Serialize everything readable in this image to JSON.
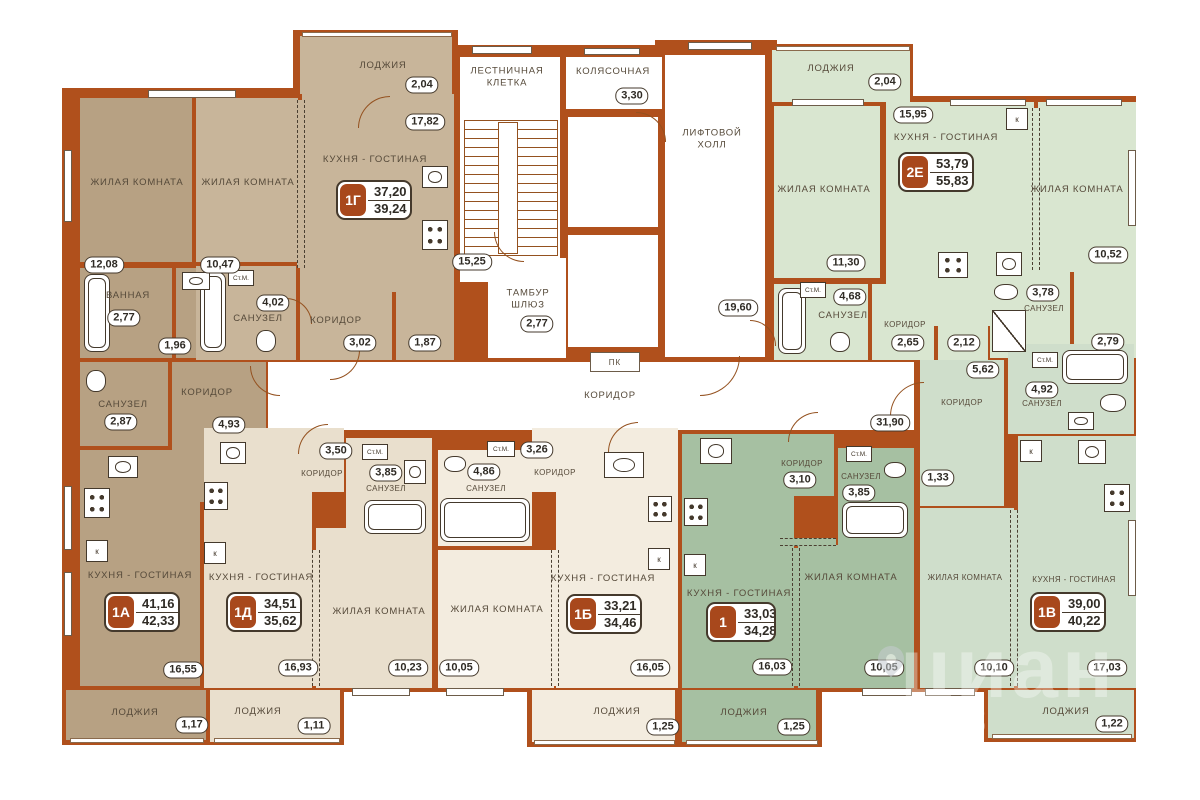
{
  "watermark": {
    "brand": "циан",
    "digits": "13"
  },
  "common": {
    "stairs": {
      "label": "ЛЕСТНИЧНАЯ КЛЕТКА",
      "area": "15,25"
    },
    "stroller": {
      "label": "КОЛЯСОЧНАЯ",
      "area": "3,30"
    },
    "lift_hall": {
      "label": "ЛИФТОВОЙ ХОЛЛ",
      "area": "19,60"
    },
    "tambour": {
      "label": "ТАМБУР ШЛЮЗ",
      "area": "2,77"
    },
    "corridor": {
      "label": "КОРИДОР",
      "area": "31,90"
    },
    "pk": "ПК",
    "washer": "Ст.М.",
    "k": "к"
  },
  "apartments": {
    "a1g": {
      "id": "1Г",
      "living_area": "37,20",
      "total_area": "39,24",
      "rooms": {
        "loggia": {
          "label": "ЛОДЖИЯ",
          "area": "2,04"
        },
        "kitchen": {
          "label": "КУХНЯ - ГОСТИНАЯ",
          "area": "17,82"
        },
        "living": {
          "label": "ЖИЛАЯ КОМНАТА",
          "area": "10,47"
        },
        "bath": {
          "label": "САНУЗЕЛ",
          "area": "4,02"
        },
        "corridor": {
          "label": "КОРИДОР",
          "area": "3,02"
        },
        "closet": {
          "area": "1,87"
        }
      }
    },
    "a1a": {
      "id": "1А",
      "living_area": "41,16",
      "total_area": "42,33",
      "rooms": {
        "living": {
          "label": "ЖИЛАЯ КОМНАТА",
          "area": "12,08"
        },
        "bathroom": {
          "label": "ВАННАЯ",
          "area": "2,77"
        },
        "hall": {
          "area": "1,96"
        },
        "wc": {
          "label": "САНУЗЕЛ",
          "area": "2,87"
        },
        "corridor": {
          "label": "КОРИДОР",
          "area": "4,93"
        },
        "kitchen": {
          "label": "КУХНЯ - ГОСТИНАЯ",
          "area": "16,55"
        },
        "loggia": {
          "label": "ЛОДЖИЯ",
          "area": "1,17"
        }
      }
    },
    "a1d": {
      "id": "1Д",
      "living_area": "34,51",
      "total_area": "35,62",
      "rooms": {
        "corridor": {
          "label": "КОРИДОР",
          "area": "3,50"
        },
        "bath": {
          "label": "САНУЗЕЛ",
          "area": "3,85"
        },
        "kitchen": {
          "label": "КУХНЯ - ГОСТИНАЯ",
          "area": "16,93"
        },
        "living": {
          "label": "ЖИЛАЯ КОМНАТА",
          "area": "10,23"
        },
        "loggia": {
          "label": "ЛОДЖИЯ",
          "area": "1,11"
        }
      }
    },
    "a1b": {
      "id": "1Б",
      "living_area": "33,21",
      "total_area": "34,46",
      "rooms": {
        "corridor": {
          "label": "КОРИДОР",
          "area": "3,26"
        },
        "bath": {
          "label": "САНУЗЕЛ",
          "area": "4,86"
        },
        "living": {
          "label": "ЖИЛАЯ КОМНАТА",
          "area": "10,05"
        },
        "kitchen": {
          "label": "КУХНЯ - ГОСТИНАЯ",
          "area": "16,05"
        },
        "loggia": {
          "label": "ЛОДЖИЯ",
          "area": "1,25"
        }
      }
    },
    "a1": {
      "id": "1",
      "living_area": "33,03",
      "total_area": "34,28",
      "rooms": {
        "corridor": {
          "label": "КОРИДОР",
          "area": "3,10"
        },
        "bath": {
          "label": "САНУЗЕЛ",
          "area": "3,85"
        },
        "kitchen": {
          "label": "КУХНЯ - ГОСТИНАЯ",
          "area": "16,03"
        },
        "living": {
          "label": "ЖИЛАЯ КОМНАТА",
          "area": "10,05"
        },
        "loggia": {
          "label": "ЛОДЖИЯ",
          "area": "1,25"
        }
      }
    },
    "a1v": {
      "id": "1В",
      "living_area": "39,00",
      "total_area": "40,22",
      "rooms": {
        "corridor": {
          "label": "КОРИДОР",
          "area": "5,62"
        },
        "bath": {
          "label": "САНУЗЕЛ",
          "area": "4,92"
        },
        "closet": {
          "area": "1,33"
        },
        "living": {
          "label": "ЖИЛАЯ КОМНАТА",
          "area": "10,10"
        },
        "kitchen": {
          "label": "КУХНЯ - ГОСТИНАЯ",
          "area": "17,03"
        },
        "loggia": {
          "label": "ЛОДЖИЯ",
          "area": "1,22"
        }
      }
    },
    "a2e": {
      "id": "2Е",
      "living_area": "53,79",
      "total_area": "55,83",
      "rooms": {
        "loggia": {
          "label": "ЛОДЖИЯ",
          "area": "2,04"
        },
        "kitchen": {
          "label": "КУХНЯ - ГОСТИНАЯ",
          "area": "15,95"
        },
        "living1": {
          "label": "ЖИЛАЯ КОМНАТА",
          "area": "11,30"
        },
        "living2": {
          "label": "ЖИЛАЯ КОМНАТА",
          "area": "10,52"
        },
        "bath1": {
          "label": "САНУЗЕЛ",
          "area": "4,68"
        },
        "corridor": {
          "label": "КОРИДОР",
          "area": "2,65"
        },
        "pass": {
          "area": "2,12"
        },
        "bath2": {
          "label": "САНУЗЕЛ",
          "area": "3,78"
        },
        "dress": {
          "area": "2,79"
        }
      }
    }
  },
  "colors": {
    "wall": "#b0501c",
    "accent_badge": "#a8481c"
  }
}
